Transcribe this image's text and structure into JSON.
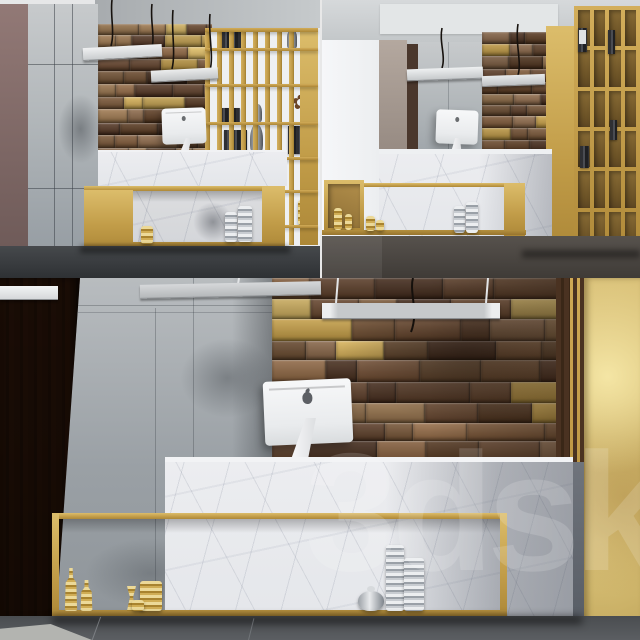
{
  "watermark": {
    "text": "3dsky"
  },
  "ornaments": {
    "flower_glyph": "✿"
  },
  "colors": {
    "gold": "#c9a44e",
    "gold_leaf": "#d9c278",
    "marble": "#e9ebee",
    "concrete": "#a9aeb3",
    "dark_wood": "#46301f",
    "mauve_wall": "#8d7470",
    "white_wall": "#f3f4f6",
    "ceiling": "#ccd0d2",
    "floor_top": "#3c3f42",
    "floor_bottom": "#54575b",
    "imac_white": "#f4f5f6",
    "silver": "#c9ccd0"
  },
  "palettes": {
    "wood": [
      "#7a5535",
      "#8a6340",
      "#66452c",
      "#55371f",
      "#95714a",
      "#4a2f1e",
      "#6e4e31",
      "#816043",
      "#5d3e28"
    ],
    "gold_blocks": [
      "#c3a04e",
      "#b99441",
      "#d0b05e"
    ],
    "gold_probability": 0.17
  }
}
